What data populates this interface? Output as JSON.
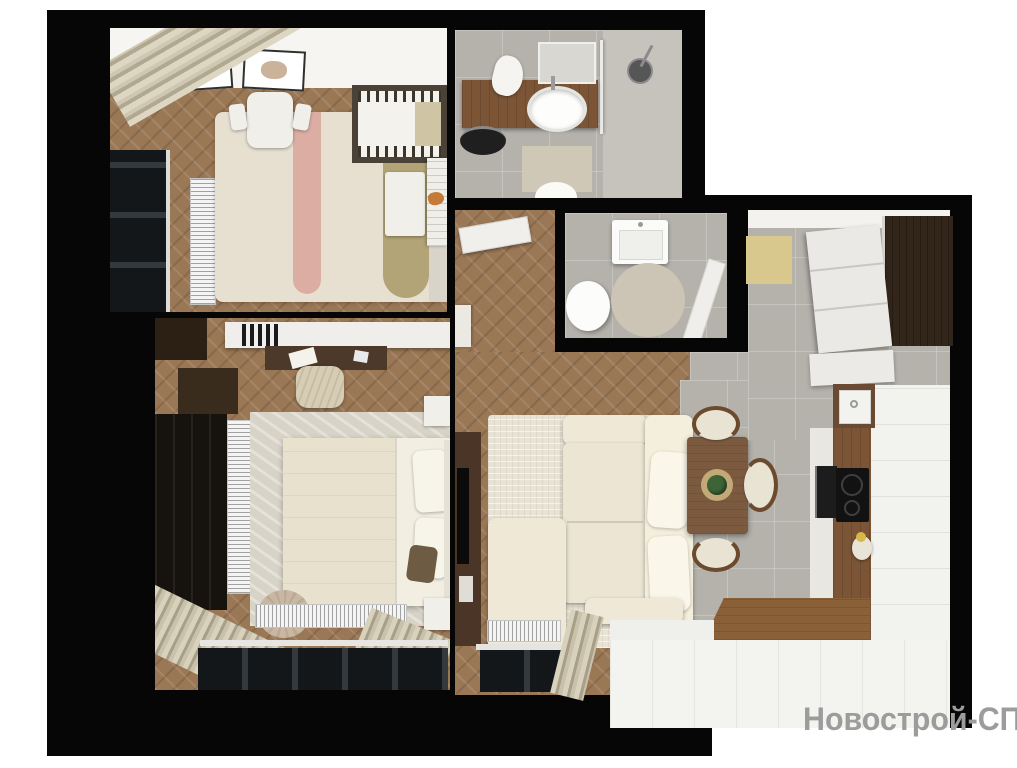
{
  "watermark": {
    "text": "Новострой-СПб",
    "color": "#9c9c9c"
  },
  "scene": {
    "type": "3d-floorplan-render-top-view",
    "background": "#ffffff",
    "colors": {
      "page": "#ffffff",
      "wall": "#060606",
      "wood": "#9b7855",
      "wood-dark": "#6b4a33",
      "tile": "#b5b2ac",
      "cream": "#efe8d7",
      "rug": "#e9e3d5",
      "accent-yellow": "#d9c88e",
      "accent-pink": "#dcaea3",
      "accent-olive": "#b2a476",
      "dark-furniture": "#16120e",
      "counter-wood": "#7b5536",
      "watermark": "#9c9c9c",
      "white-f": "#f2f1ed"
    },
    "rooms": [
      {
        "id": "nursery",
        "floor": "wood-herringbone",
        "furniture": [
          "fox-wall-art",
          "bunny-wall-art",
          "striped-curtains",
          "window",
          "vertical-radiator",
          "striped-rug",
          "kids-table",
          "two-kids-chairs",
          "crib",
          "toy-bench",
          "dresser",
          "fox-toy"
        ]
      },
      {
        "id": "bathroom",
        "floor": "gray-tile",
        "furniture": [
          "wood-vanity",
          "oval-sink",
          "mirror",
          "towel",
          "laundry-basket",
          "bath-mat",
          "shower-glass",
          "shower-head",
          "toilet"
        ]
      },
      {
        "id": "wc",
        "floor": "gray-tile",
        "furniture": [
          "small-sink",
          "toilet",
          "round-rug",
          "open-door"
        ]
      },
      {
        "id": "hallway",
        "floor": "wood-herringbone",
        "furniture": [
          "open-door-to-bathroom",
          "shelf"
        ]
      },
      {
        "id": "living-room",
        "floor": "wood-herringbone",
        "furniture": [
          "corner-sofa",
          "cushions",
          "area-rug",
          "tv-console",
          "tv",
          "radiator",
          "window",
          "curtain",
          "dining-table",
          "jute-placemat",
          "plant-centerpiece",
          "three-dining-chairs"
        ]
      },
      {
        "id": "kitchen",
        "floor": "gray-tile-and-white",
        "furniture": [
          "yellow-mat",
          "tall-dark-cabinet",
          "white-drawer-units",
          "square-sink",
          "wood-counter-run",
          "oven",
          "cooktop",
          "kettle",
          "white-base-cabinets",
          "loggia-floor"
        ]
      },
      {
        "id": "bedroom",
        "floor": "wood-herringbone",
        "furniture": [
          "wall-shelf",
          "books",
          "desk",
          "paper",
          "tablet",
          "lounge-chair",
          "dark-cabinet",
          "wardrobe",
          "vertical-radiator",
          "area-rug",
          "double-bed",
          "blanket",
          "pillows",
          "dark-pillow",
          "headboard",
          "two-nightstands",
          "pouf",
          "horizontal-radiator",
          "curtains",
          "window"
        ]
      }
    ]
  }
}
